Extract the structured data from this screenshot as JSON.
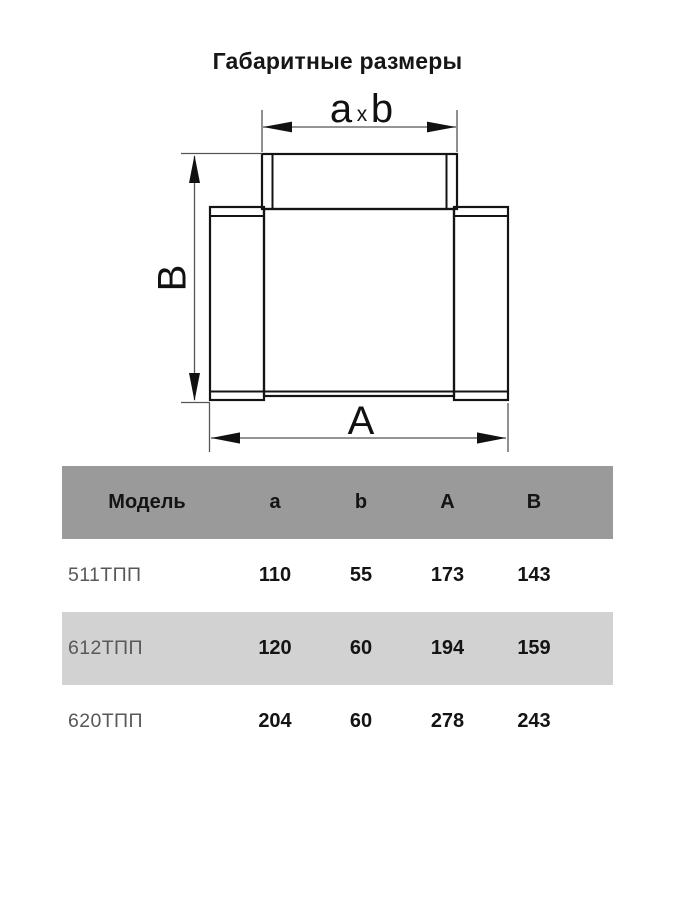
{
  "title": "Габаритные размеры",
  "diagram": {
    "top_dim_a": "a",
    "top_dim_x": "x",
    "top_dim_b": "b",
    "side_dim": "B",
    "bottom_dim": "A",
    "line_color": "#141414",
    "dim_line_color": "#555555"
  },
  "table": {
    "header": {
      "model": "Модель",
      "a": "a",
      "b": "b",
      "A": "A",
      "B": "B"
    },
    "rows": [
      {
        "model": "511ТПП",
        "a": "110",
        "b": "55",
        "A": "173",
        "B": "143"
      },
      {
        "model": "612ТПП",
        "a": "120",
        "b": "60",
        "A": "194",
        "B": "159"
      },
      {
        "model": "620ТПП",
        "a": "204",
        "b": "60",
        "A": "278",
        "B": "243"
      }
    ],
    "colors": {
      "header_bg": "#9a9a9a",
      "alt_row_bg": "#d2d2d2",
      "model_text": "#585858"
    }
  }
}
